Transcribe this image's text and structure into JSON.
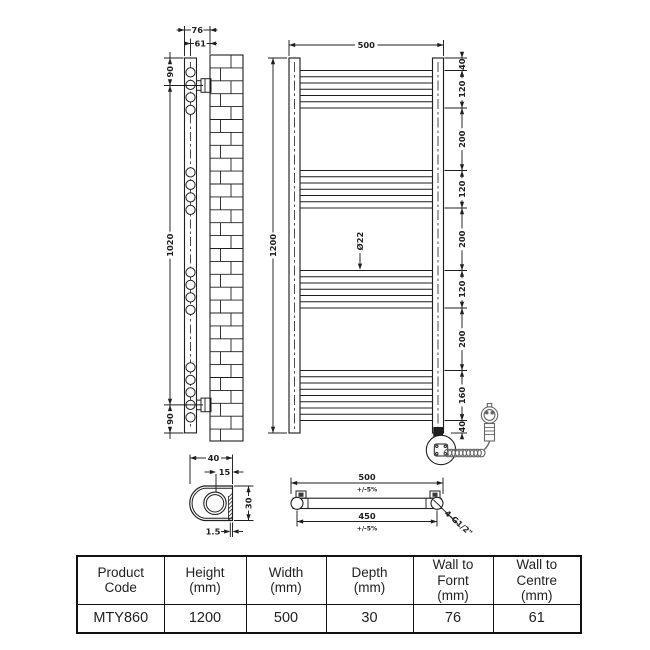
{
  "drawing": {
    "side_view": {
      "wall_to_front": "76",
      "wall_to_centre": "61",
      "top_fixing": "90",
      "fixing_centres": "1020",
      "bottom_fixing": "90"
    },
    "front_view": {
      "width": "500",
      "height": "1200",
      "right_chain": [
        "40",
        "120",
        "200",
        "120",
        "200",
        "120",
        "200",
        "160",
        "40"
      ],
      "tube_diameter": "Ø22"
    },
    "profile_detail": {
      "depth": "40",
      "centre_offset": "15",
      "height": "30",
      "wall_thickness": "1.5"
    },
    "plan_view": {
      "overall_width": "500",
      "overall_tolerance": "+/-5%",
      "pipe_centres": "450",
      "centres_tolerance": "+/-5%",
      "connections": "4-G1/2\""
    }
  },
  "table": {
    "headers": [
      "Product\nCode",
      "Height\n(mm)",
      "Width\n(mm)",
      "Depth\n(mm)",
      "Wall to\nFornt\n(mm)",
      "Wall to\nCentre\n(mm)"
    ],
    "row": [
      "MTY860",
      "1200",
      "500",
      "30",
      "76",
      "61"
    ]
  },
  "colors": {
    "line": "#1f1f1f",
    "gray": "#666666"
  }
}
